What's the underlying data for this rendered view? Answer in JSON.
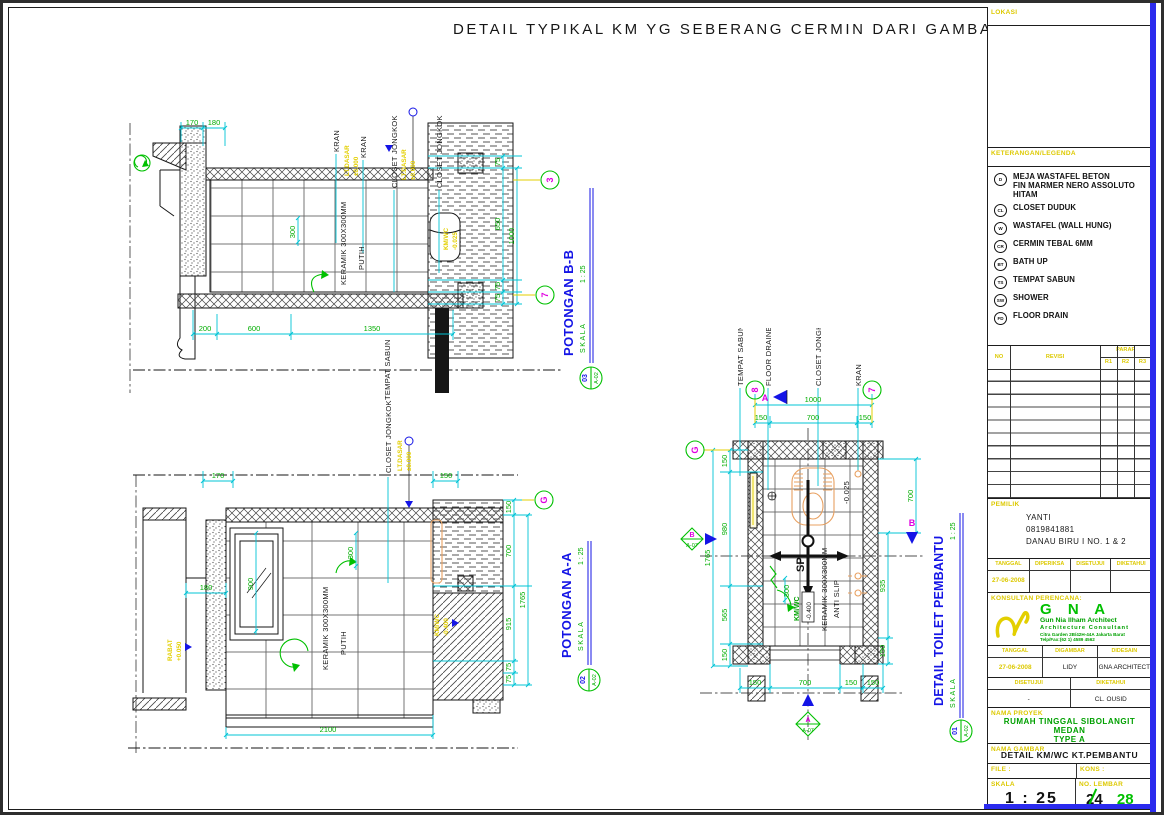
{
  "sheet": {
    "title": "DETAIL TYPIKAL KM YG SEBERANG CERMIN DARI GAMBAR INI"
  },
  "dwg1": {
    "title": "POTONGAN B-B",
    "no": "03",
    "ref": "A-02",
    "skala_label": "SKALA",
    "scale": "1 : 25",
    "labels": {
      "kran": "KRAN",
      "closet": "CLOSET JONGKOK",
      "lt_dasar": "LT.DASAR",
      "zero": "±0.000",
      "keramik": "KERAMIK 300X300MM",
      "putih": "PUTIH",
      "tempat_sabun": "TEMPAT SABUN",
      "kmwc": "KM/WC",
      "kmwc_lvl": "-0.025"
    },
    "dims": {
      "d170": "170",
      "d180": "180",
      "d300": "300",
      "d200": "200",
      "d600": "600",
      "d1350": "1350",
      "d75": "75",
      "d650": "650",
      "d1000": "1000"
    },
    "grids": {
      "top": "3",
      "bottom": "7"
    }
  },
  "dwg2": {
    "title": "POTONGAN A-A",
    "no": "02",
    "ref": "A-02",
    "skala_label": "SKALA",
    "scale": "1 : 25",
    "labels": {
      "closet": "CLOSET JONGKOK",
      "lt_dasar": "LT.DASAR",
      "zero": "±0.000",
      "keramik": "KERAMIK 300X300MM",
      "putih": "PUTIH",
      "rabat": "RABAT",
      "rabat_lvl": "+0.050",
      "kmwc": "KM/WC",
      "kmwc_lvl": "-0.400"
    },
    "dims": {
      "d170": "170",
      "d150": "150",
      "d180": "180",
      "d900": "900",
      "d300": "300",
      "d2100": "2100",
      "d700": "700",
      "d915": "915",
      "d1765": "1765",
      "d75": "75"
    },
    "grids": {
      "g": "G"
    }
  },
  "dwg3": {
    "title": "DETAIL TOILET PEMBANTU",
    "no": "01",
    "ref": "A-02",
    "skala_label": "SKALA",
    "scale": "1 : 25",
    "labels": {
      "tempat_sabun": "TEMPAT SABUN",
      "floor_draine": "FLOOR DRAINE",
      "closet": "CLOSET JONGKOK",
      "kran": "KRAN",
      "lvl": "-0.025",
      "sp": "SP",
      "kmwc": "KM/WC",
      "kmwc_lvl": "-0.400",
      "keramik": "KERAMIK 300X300MM",
      "anti_slip": "ANTI SLIP"
    },
    "dims": {
      "d1000": "1000",
      "d150": "150",
      "d700": "700",
      "d980": "980",
      "d565": "565",
      "d1765": "1765",
      "d300": "300",
      "d935": "935"
    },
    "grids": {
      "left": "8",
      "right": "7",
      "g": "G"
    },
    "markers": {
      "a": "A",
      "b": "B",
      "ref": "A-07"
    }
  },
  "titleblock": {
    "lokasi": {
      "header": "LOKASI"
    },
    "legend": {
      "header": "KETERANGAN/LEGENDA",
      "items": [
        {
          "code": "D",
          "label": "MEJA WASTAFEL BETON",
          "label2": "FIN MARMER NERO ASSOLUTO HITAM"
        },
        {
          "code": "CL",
          "label": "CLOSET DUDUK",
          "label2": ""
        },
        {
          "code": "W",
          "label": "WASTAFEL (WALL HUNG)",
          "label2": ""
        },
        {
          "code": "CR",
          "label": "CERMIN TEBAL 6MM",
          "label2": ""
        },
        {
          "code": "BT",
          "label": "BATH UP",
          "label2": ""
        },
        {
          "code": "TS",
          "label": "TEMPAT SABUN",
          "label2": ""
        },
        {
          "code": "SW",
          "label": "SHOWER",
          "label2": ""
        },
        {
          "code": "FD",
          "label": "FLOOR DRAIN",
          "label2": ""
        }
      ]
    },
    "revision": {
      "no": "NO",
      "revisi": "REVISI",
      "paraf": "PARAF",
      "r1": "R1",
      "r2": "R2",
      "r3": "R3"
    },
    "pemilik": {
      "header": "PEMILIK",
      "name": "YANTI",
      "phone": "0819841881",
      "address": "DANAU BIRU I NO. 1 & 2"
    },
    "approval1": {
      "c1": "TANGGAL",
      "c2": "DIPERIKSA",
      "c3": "DISETUJUI",
      "c4": "DIKETAHUI",
      "v1": "27-06-2008"
    },
    "konsultan": {
      "header": "KONSULTAN PERENCANA:",
      "logo": "G N A",
      "line1": "Gun Nia Ilham Architect",
      "line2": "Architecture Consultant",
      "line3": "Citra Garden 2B/42H-44A Jakarta Barat",
      "line4": "Telp/Fax:(62 1) 4589 4562"
    },
    "approval2": {
      "c1": "TANGGAL",
      "c2": "DIGAMBAR",
      "c3": "DIDESAIN",
      "v1": "27-06-2008",
      "v2": "LIDY",
      "v3": "GNA ARCHITECT"
    },
    "approval3": {
      "c1": "DISETUJUI",
      "c2": "DIKETAHUI",
      "v1": "-",
      "v2": "CL. OUSID"
    },
    "proyek": {
      "header": "NAMA PROYEK",
      "line1": "RUMAH TINGGAL SIBOLANGIT MEDAN",
      "line2": "TYPE A"
    },
    "gambar": {
      "header": "NAMA GAMBAR",
      "value": "DETAIL KM/WC KT.PEMBANTU"
    },
    "file": {
      "file_label": "FILE :",
      "kons_label": "KONS :"
    },
    "skala": {
      "header": "SKALA",
      "value": "1 : 25"
    },
    "lembar": {
      "header": "NO. LEMBAR",
      "old": "24",
      "new": "28"
    }
  }
}
